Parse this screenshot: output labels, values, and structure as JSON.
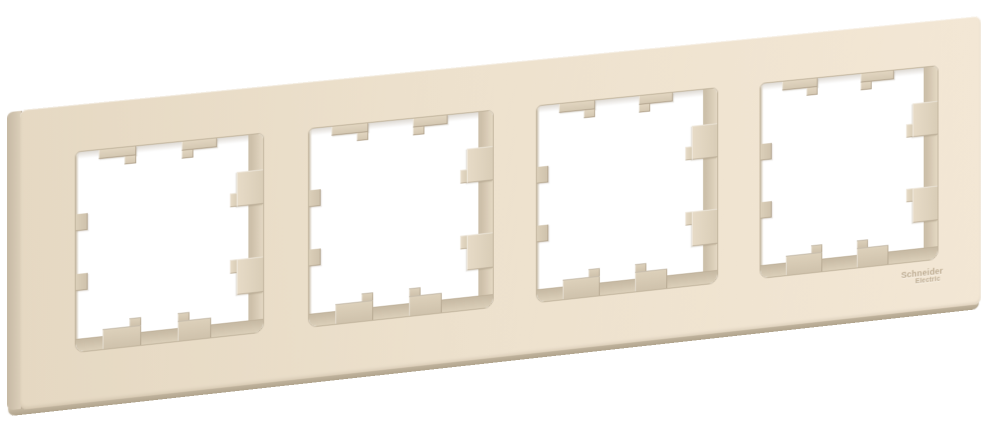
{
  "scene": {
    "type": "product-photo",
    "subject": "4-gang wall plate frame",
    "background": "#ffffff"
  },
  "brand": {
    "logo_line1": "Schneider",
    "logo_line2": "Electric"
  },
  "frame": {
    "window_count": 4,
    "finish": "beige"
  },
  "colors": {
    "frame_face": "#ede1cd",
    "frame_face_light": "#f3e7d5",
    "frame_face_dark": "#e5d8c2",
    "frame_side": "#d5c8b3",
    "frame_bottom_edge": "#b0a38c",
    "inner_wall": "#d2c5ae",
    "inner_wall_shadow": "#b7aa92",
    "clip_tab": "#dcd0ba",
    "logo_text": "#b3a084"
  }
}
